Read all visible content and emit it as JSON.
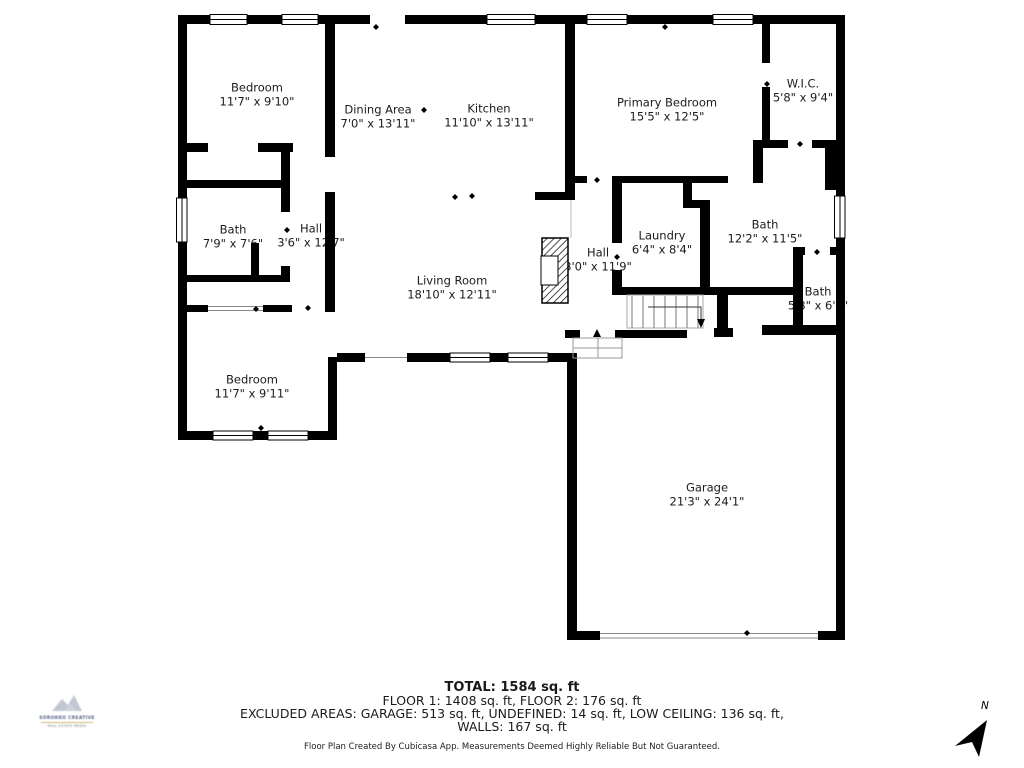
{
  "rooms": {
    "bedroom_top": {
      "name": "Bedroom",
      "dims": "11'7\" x 9'10\""
    },
    "dining": {
      "name": "Dining Area",
      "dims": "7'0\" x 13'11\""
    },
    "kitchen": {
      "name": "Kitchen",
      "dims": "11'10\" x 13'11\""
    },
    "primary": {
      "name": "Primary Bedroom",
      "dims": "15'5\" x 12'5\""
    },
    "wic": {
      "name": "W.I.C.",
      "dims": "5'8\" x 9'4\""
    },
    "bath_left": {
      "name": "Bath",
      "dims": "7'9\" x 7'6\""
    },
    "hall_left": {
      "name": "Hall",
      "dims": "3'6\" x 12'7\""
    },
    "living": {
      "name": "Living Room",
      "dims": "18'10\" x 12'11\""
    },
    "hall_center": {
      "name": "Hall",
      "dims": "3'0\" x 11'9\""
    },
    "laundry": {
      "name": "Laundry",
      "dims": "6'4\" x 8'4\""
    },
    "bath_right": {
      "name": "Bath",
      "dims": "12'2\" x 11'5\""
    },
    "bath_small": {
      "name": "Bath",
      "dims": "5'3\" x 6'2\""
    },
    "bedroom_bottom": {
      "name": "Bedroom",
      "dims": "11'7\" x 9'11\""
    },
    "garage": {
      "name": "Garage",
      "dims": "21'3\" x 24'1\""
    }
  },
  "summary": {
    "total": "TOTAL: 1584 sq. ft",
    "floors": "FLOOR 1: 1408 sq. ft, FLOOR 2: 176 sq. ft",
    "excluded": "EXCLUDED AREAS: GARAGE: 513 sq. ft, UNDEFINED: 14 sq. ft, LOW CEILING: 136 sq. ft,",
    "walls": "WALLS: 167 sq. ft",
    "disclaimer": "Floor Plan Created By Cubicasa App. Measurements Deemed Highly Reliable But Not Guaranteed."
  },
  "compass": {
    "label": "N"
  },
  "watermark": {
    "line1": "SOROKKO CREATIVE",
    "line2": "REAL ESTATE MEDIA"
  },
  "colors": {
    "wall": "#000000",
    "thin_line": "#888888",
    "gold": "#c9a44c",
    "logo_blue": "#2b3a6b"
  }
}
